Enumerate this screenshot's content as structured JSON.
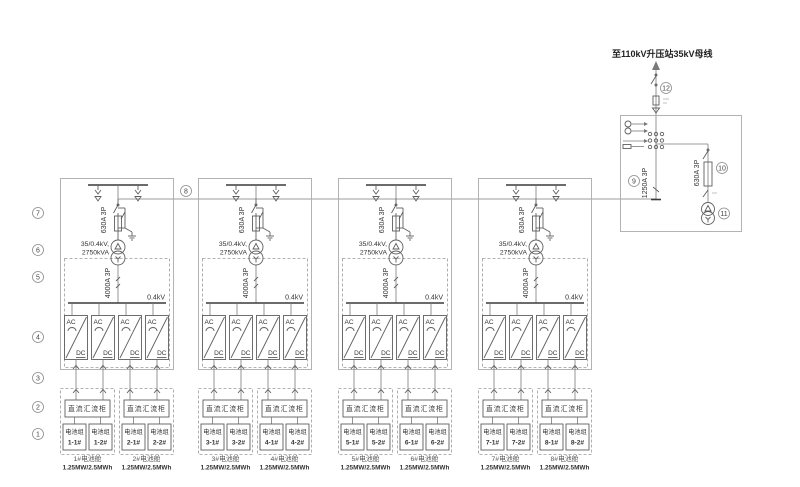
{
  "diagram": {
    "collector": {
      "bus_label": "至110kV升压站35kV母线",
      "main_breaker_label": "1250A 3P",
      "aux_branch_label": "630A 3P"
    },
    "refs": {
      "r1": "1",
      "r2": "2",
      "r3": "3",
      "r4": "4",
      "r5": "5",
      "r6": "6",
      "r7": "7",
      "r8": "8",
      "r9": "9",
      "r10": "10",
      "r11": "11",
      "r12": "12"
    },
    "block_common": {
      "hv_switch": "630A 3P",
      "tx_line1": "35/0.4kV,",
      "tx_line2": "2750kVA",
      "lv_switch": "4000A 3P",
      "lv_bus": "0.4kV",
      "ac": "AC",
      "dc": "DC",
      "combiner": "直流汇流柜"
    },
    "blocks": [
      {
        "cabins": [
          {
            "name": "1#电池舱",
            "rating": "1.25MW/2.5MWh",
            "groups": [
              {
                "t": "电池组",
                "n": "1-1#"
              },
              {
                "t": "电池组",
                "n": "1-2#"
              }
            ]
          },
          {
            "name": "2#电池舱",
            "rating": "1.25MW/2.5MWh",
            "groups": [
              {
                "t": "电池组",
                "n": "2-1#"
              },
              {
                "t": "电池组",
                "n": "2-2#"
              }
            ]
          }
        ]
      },
      {
        "cabins": [
          {
            "name": "3#电池舱",
            "rating": "1.25MW/2.5MWh",
            "groups": [
              {
                "t": "电池组",
                "n": "3-1#"
              },
              {
                "t": "电池组",
                "n": "3-2#"
              }
            ]
          },
          {
            "name": "4#电池舱",
            "rating": "1.25MW/2.5MWh",
            "groups": [
              {
                "t": "电池组",
                "n": "4-1#"
              },
              {
                "t": "电池组",
                "n": "4-2#"
              }
            ]
          }
        ]
      },
      {
        "cabins": [
          {
            "name": "5#电池舱",
            "rating": "1.25MW/2.5MWh",
            "groups": [
              {
                "t": "电池组",
                "n": "5-1#"
              },
              {
                "t": "电池组",
                "n": "5-2#"
              }
            ]
          },
          {
            "name": "6#电池舱",
            "rating": "1.25MW/2.5MWh",
            "groups": [
              {
                "t": "电池组",
                "n": "6-1#"
              },
              {
                "t": "电池组",
                "n": "6-2#"
              }
            ]
          }
        ]
      },
      {
        "cabins": [
          {
            "name": "7#电池舱",
            "rating": "1.25MW/2.5MWh",
            "groups": [
              {
                "t": "电池组",
                "n": "7-1#"
              },
              {
                "t": "电池组",
                "n": "7-2#"
              }
            ]
          },
          {
            "name": "8#电池舱",
            "rating": "1.25MW/2.5MWh",
            "groups": [
              {
                "t": "电池组",
                "n": "8-1#"
              },
              {
                "t": "电池组",
                "n": "8-2#"
              }
            ]
          }
        ]
      }
    ],
    "colors": {
      "line": "#777777",
      "bus": "#3a3a3a",
      "box": "#ababab",
      "text": "#333333"
    }
  }
}
